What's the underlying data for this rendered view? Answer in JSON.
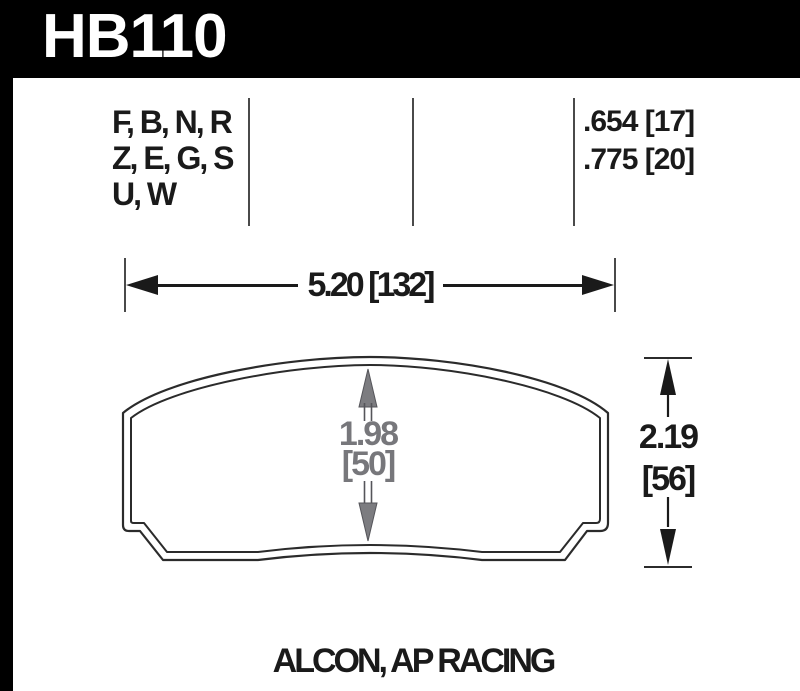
{
  "header": {
    "part_number": "HB110"
  },
  "compound_section": {
    "compound_lines": [
      "F, B, N, R",
      "Z, E, G, S",
      "U, W"
    ],
    "pad_thickness_values": [
      ".654 [17]",
      ".775 [20]"
    ]
  },
  "dimensions": {
    "width_label": "5.20 [132]",
    "inner_height_line1": "1.98",
    "inner_height_line2": "[50]",
    "overall_height_line1": "2.19",
    "overall_height_line2": "[56]"
  },
  "footer": {
    "applications_label": "ALCON, AP RACING"
  },
  "colors": {
    "header_bg": "#000000",
    "header_text": "#ffffff",
    "outline_color": "#2b2b2b",
    "divider_color": "#4a4a4a",
    "gray_dim_color": "#77777b",
    "black_dim_color": "#1a1a1a"
  }
}
